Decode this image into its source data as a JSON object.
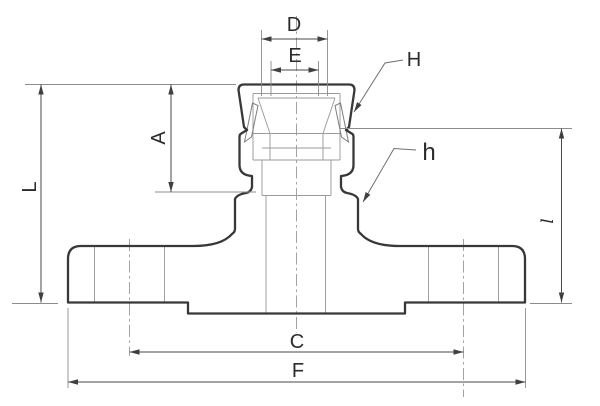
{
  "drawing": {
    "type": "technical-dimension-drawing",
    "subject": "flanged compression fitting cross-section",
    "background": "#ffffff",
    "colors": {
      "outline": "#383838",
      "dimension_lines": "#4a4a4a",
      "extension_lines": "#8c8c8c",
      "centerlines": "#9a9a9a",
      "internal_lines": "#9b9b9b",
      "label_text": "#2b2b2b"
    },
    "labels": {
      "D": "D",
      "E": "E",
      "H": "H",
      "A": "A",
      "L": "L",
      "h": "h",
      "l": "l",
      "C": "C",
      "F": "F"
    },
    "dimensions": [
      {
        "label": "D",
        "orientation": "horizontal",
        "location": "top"
      },
      {
        "label": "E",
        "orientation": "horizontal",
        "location": "top"
      },
      {
        "label": "A",
        "orientation": "vertical",
        "location": "upper-left"
      },
      {
        "label": "L",
        "orientation": "vertical",
        "location": "left"
      },
      {
        "label": "l",
        "orientation": "vertical",
        "location": "right"
      },
      {
        "label": "C",
        "orientation": "horizontal",
        "location": "bottom"
      },
      {
        "label": "F",
        "orientation": "horizontal",
        "location": "bottom"
      },
      {
        "label": "H",
        "orientation": "leader",
        "location": "upper-right"
      },
      {
        "label": "h",
        "orientation": "leader",
        "location": "middle-right"
      }
    ]
  }
}
